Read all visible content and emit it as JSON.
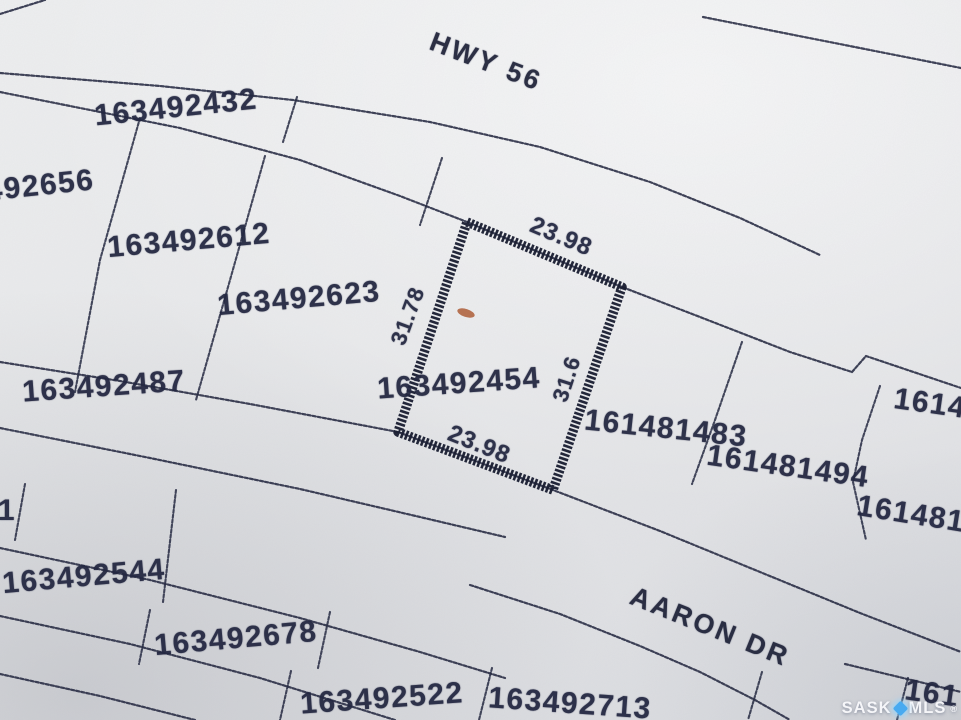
{
  "map": {
    "roads": {
      "highway": "HWY 56",
      "drive": "AARON DR"
    },
    "highlighted_parcel": {
      "id": "163492454",
      "dim_top": "23.98",
      "dim_left": "31.78",
      "dim_right": "31.6",
      "dim_bottom": "23.98"
    },
    "parcels": [
      {
        "id": "163492432"
      },
      {
        "id": "492656"
      },
      {
        "id": "163492612"
      },
      {
        "id": "163492623"
      },
      {
        "id": "163492487"
      },
      {
        "id": "161481483"
      },
      {
        "id": "161481494"
      },
      {
        "id": "1614"
      },
      {
        "id": "1614815"
      },
      {
        "id": "1"
      },
      {
        "id": "163492544"
      },
      {
        "id": "163492678"
      },
      {
        "id": "163492522"
      },
      {
        "id": "163492713"
      },
      {
        "id": "161"
      }
    ],
    "watermark": {
      "left": "SASK",
      "right": "MLS",
      "registered": "®",
      "icon": "sparkle-diamond",
      "icon_color": "#49aaf0"
    },
    "colors": {
      "paper": "#e6e7ea",
      "ink": "#232741",
      "highlight_outline": "#1a1e32",
      "stain": "#a9542c"
    }
  }
}
